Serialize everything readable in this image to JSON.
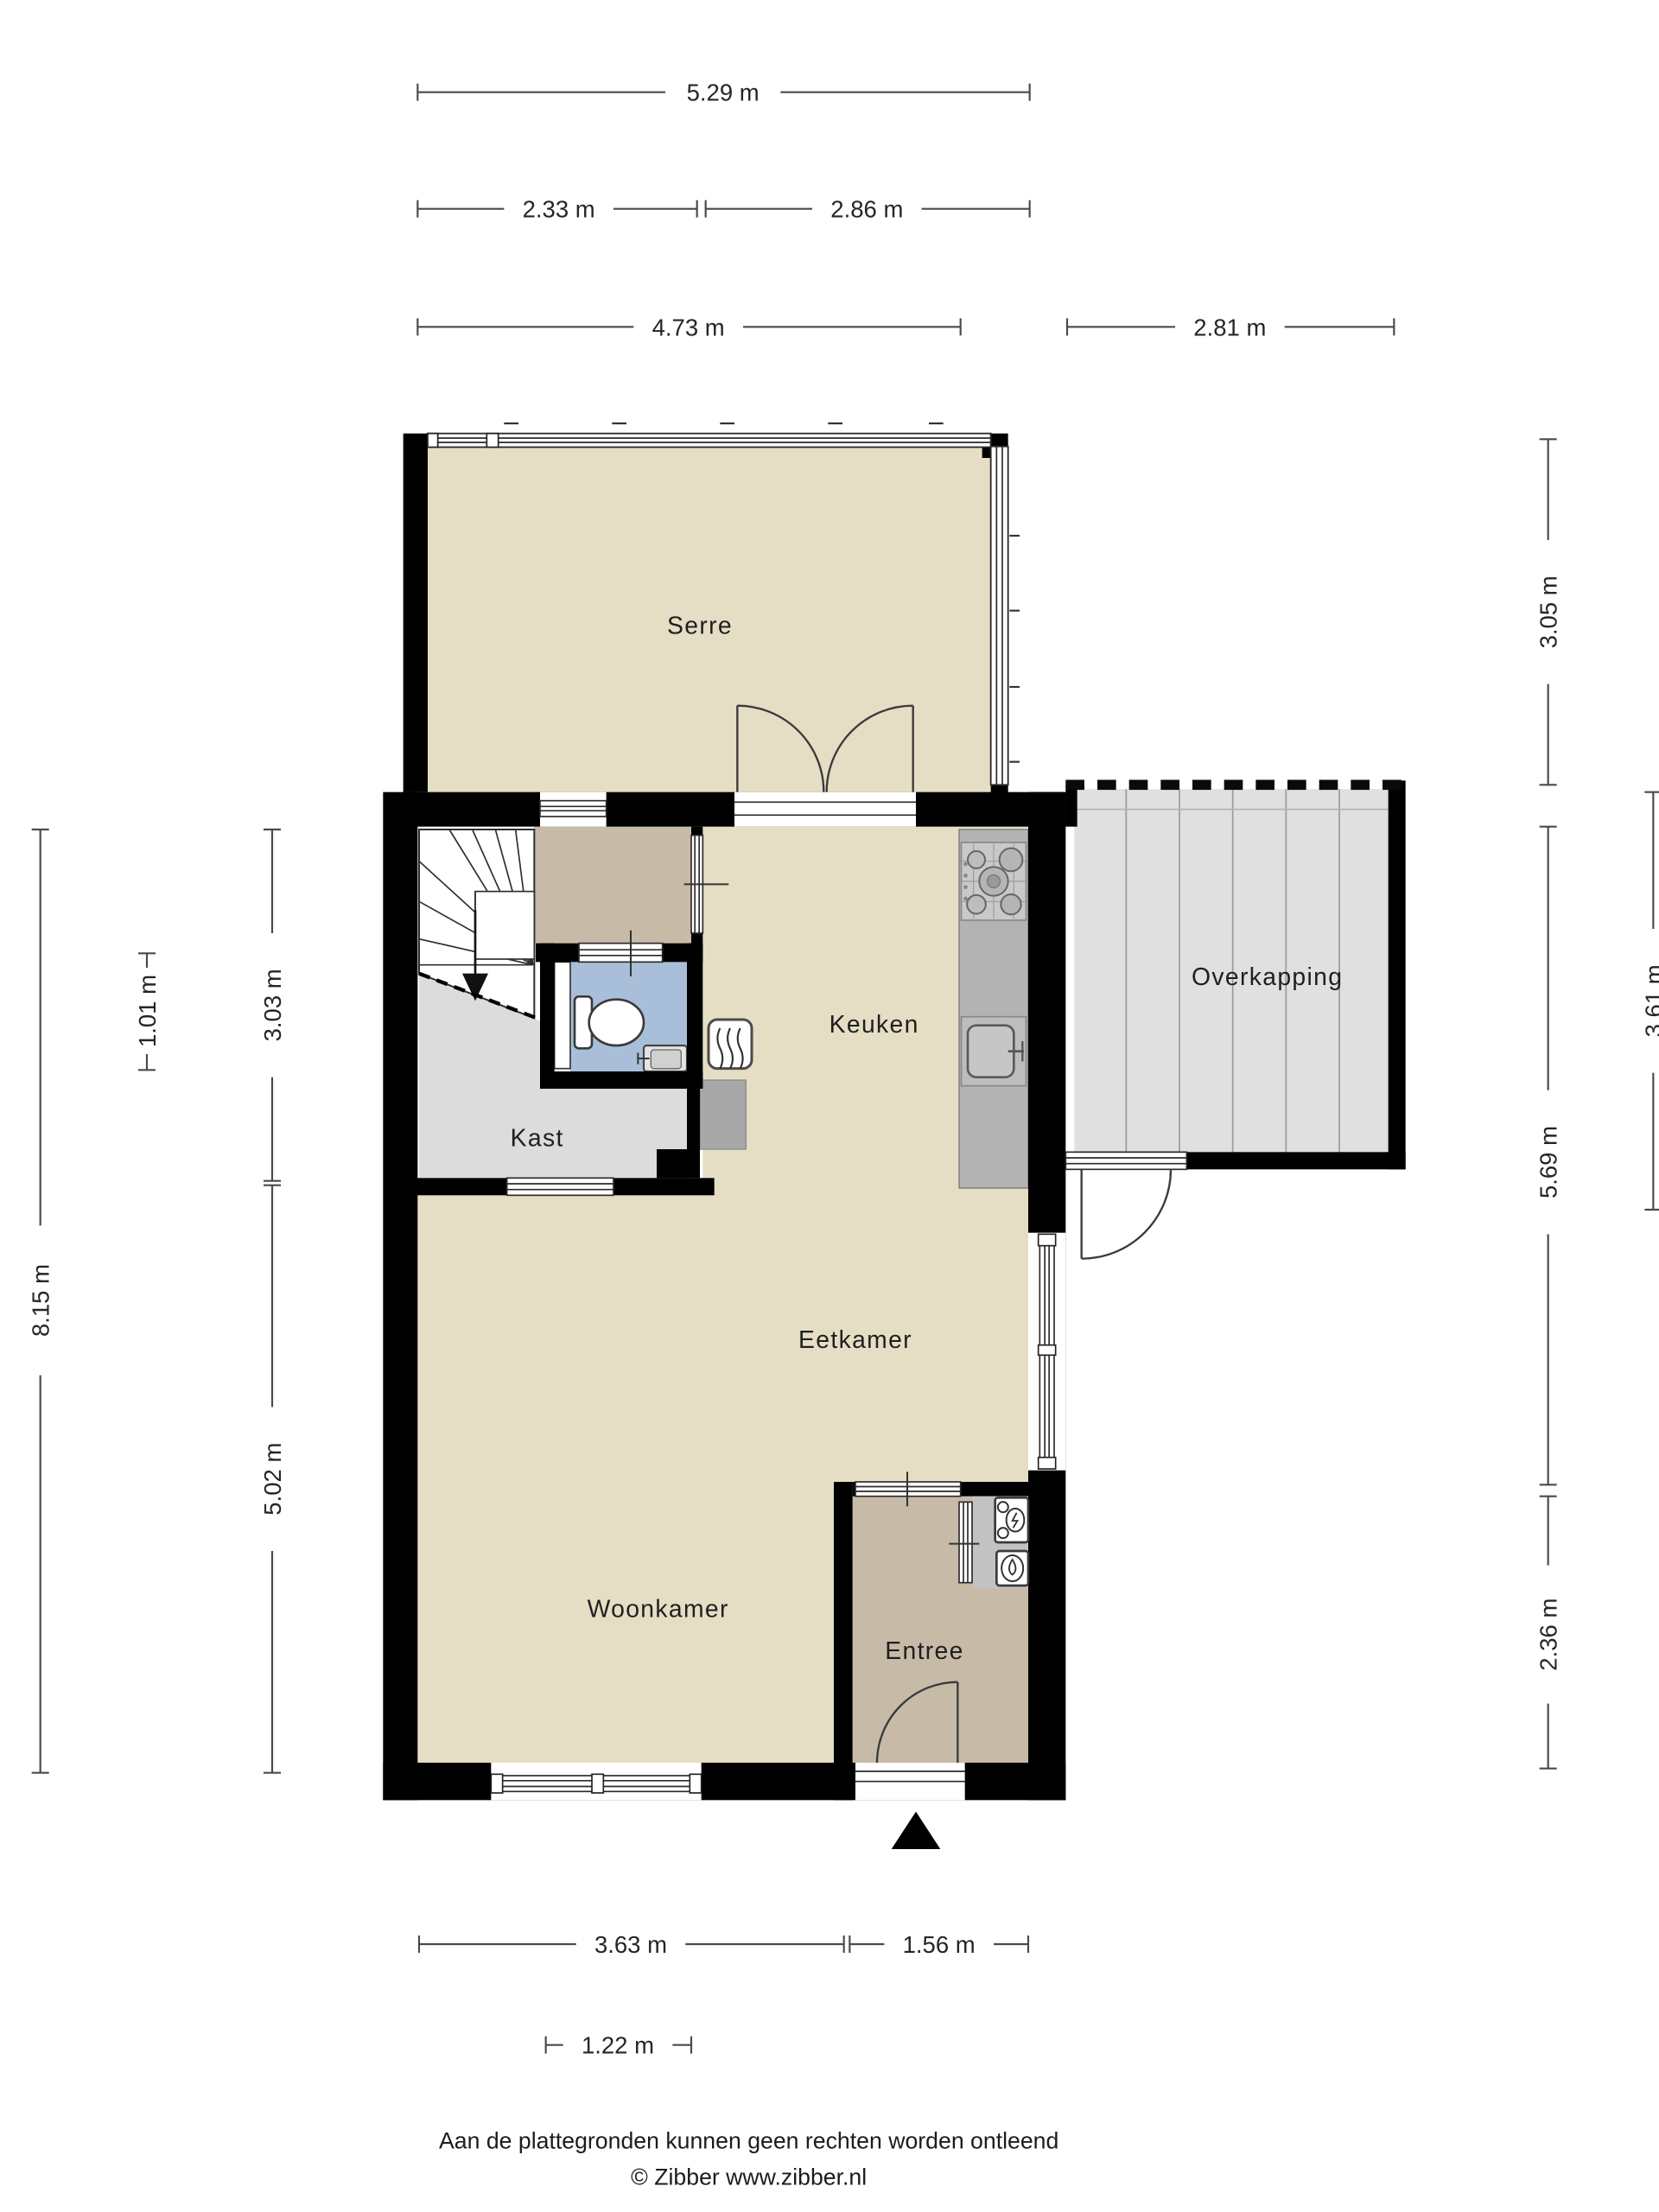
{
  "document": {
    "type": "floor-plan",
    "disclaimer": "Aan de plattegronden kunnen geen rechten worden ontleend",
    "credit": "© Zibber www.zibber.nl"
  },
  "rooms": {
    "serre": {
      "label": "Serre"
    },
    "keuken": {
      "label": "Keuken"
    },
    "overkapping": {
      "label": "Overkapping"
    },
    "kast": {
      "label": "Kast"
    },
    "eetkamer": {
      "label": "Eetkamer"
    },
    "woonkamer": {
      "label": "Woonkamer"
    },
    "entree": {
      "label": "Entree"
    }
  },
  "dimensions": {
    "d529": {
      "label": "5.29 m"
    },
    "d233": {
      "label": "2.33 m"
    },
    "d286": {
      "label": "2.86 m"
    },
    "d473": {
      "label": "4.73 m"
    },
    "d281": {
      "label": "2.81 m"
    },
    "d363": {
      "label": "3.63 m"
    },
    "d156": {
      "label": "1.56 m"
    },
    "d122": {
      "label": "1.22 m"
    },
    "d101": {
      "label": "1.01 m"
    },
    "d303": {
      "label": "3.03 m"
    },
    "d815": {
      "label": "8.15 m"
    },
    "d502": {
      "label": "5.02 m"
    },
    "d305": {
      "label": "3.05 m"
    },
    "d361": {
      "label": "3.61 m"
    },
    "d569": {
      "label": "5.69 m"
    },
    "d236": {
      "label": "2.36 m"
    }
  },
  "colors": {
    "wall": "#000000",
    "floor_main": "#e6dec4",
    "floor_hal": "#c7bba8",
    "floor_entree": "#c7bba8",
    "floor_toilet": "#a9bfd9",
    "floor_kast": "#dcdcdc",
    "floor_overkapping": "#e0e0e0",
    "counter": "#b3b3b3",
    "appliance": "#a8a8a8",
    "meter_niche": "#c2c2c2"
  }
}
